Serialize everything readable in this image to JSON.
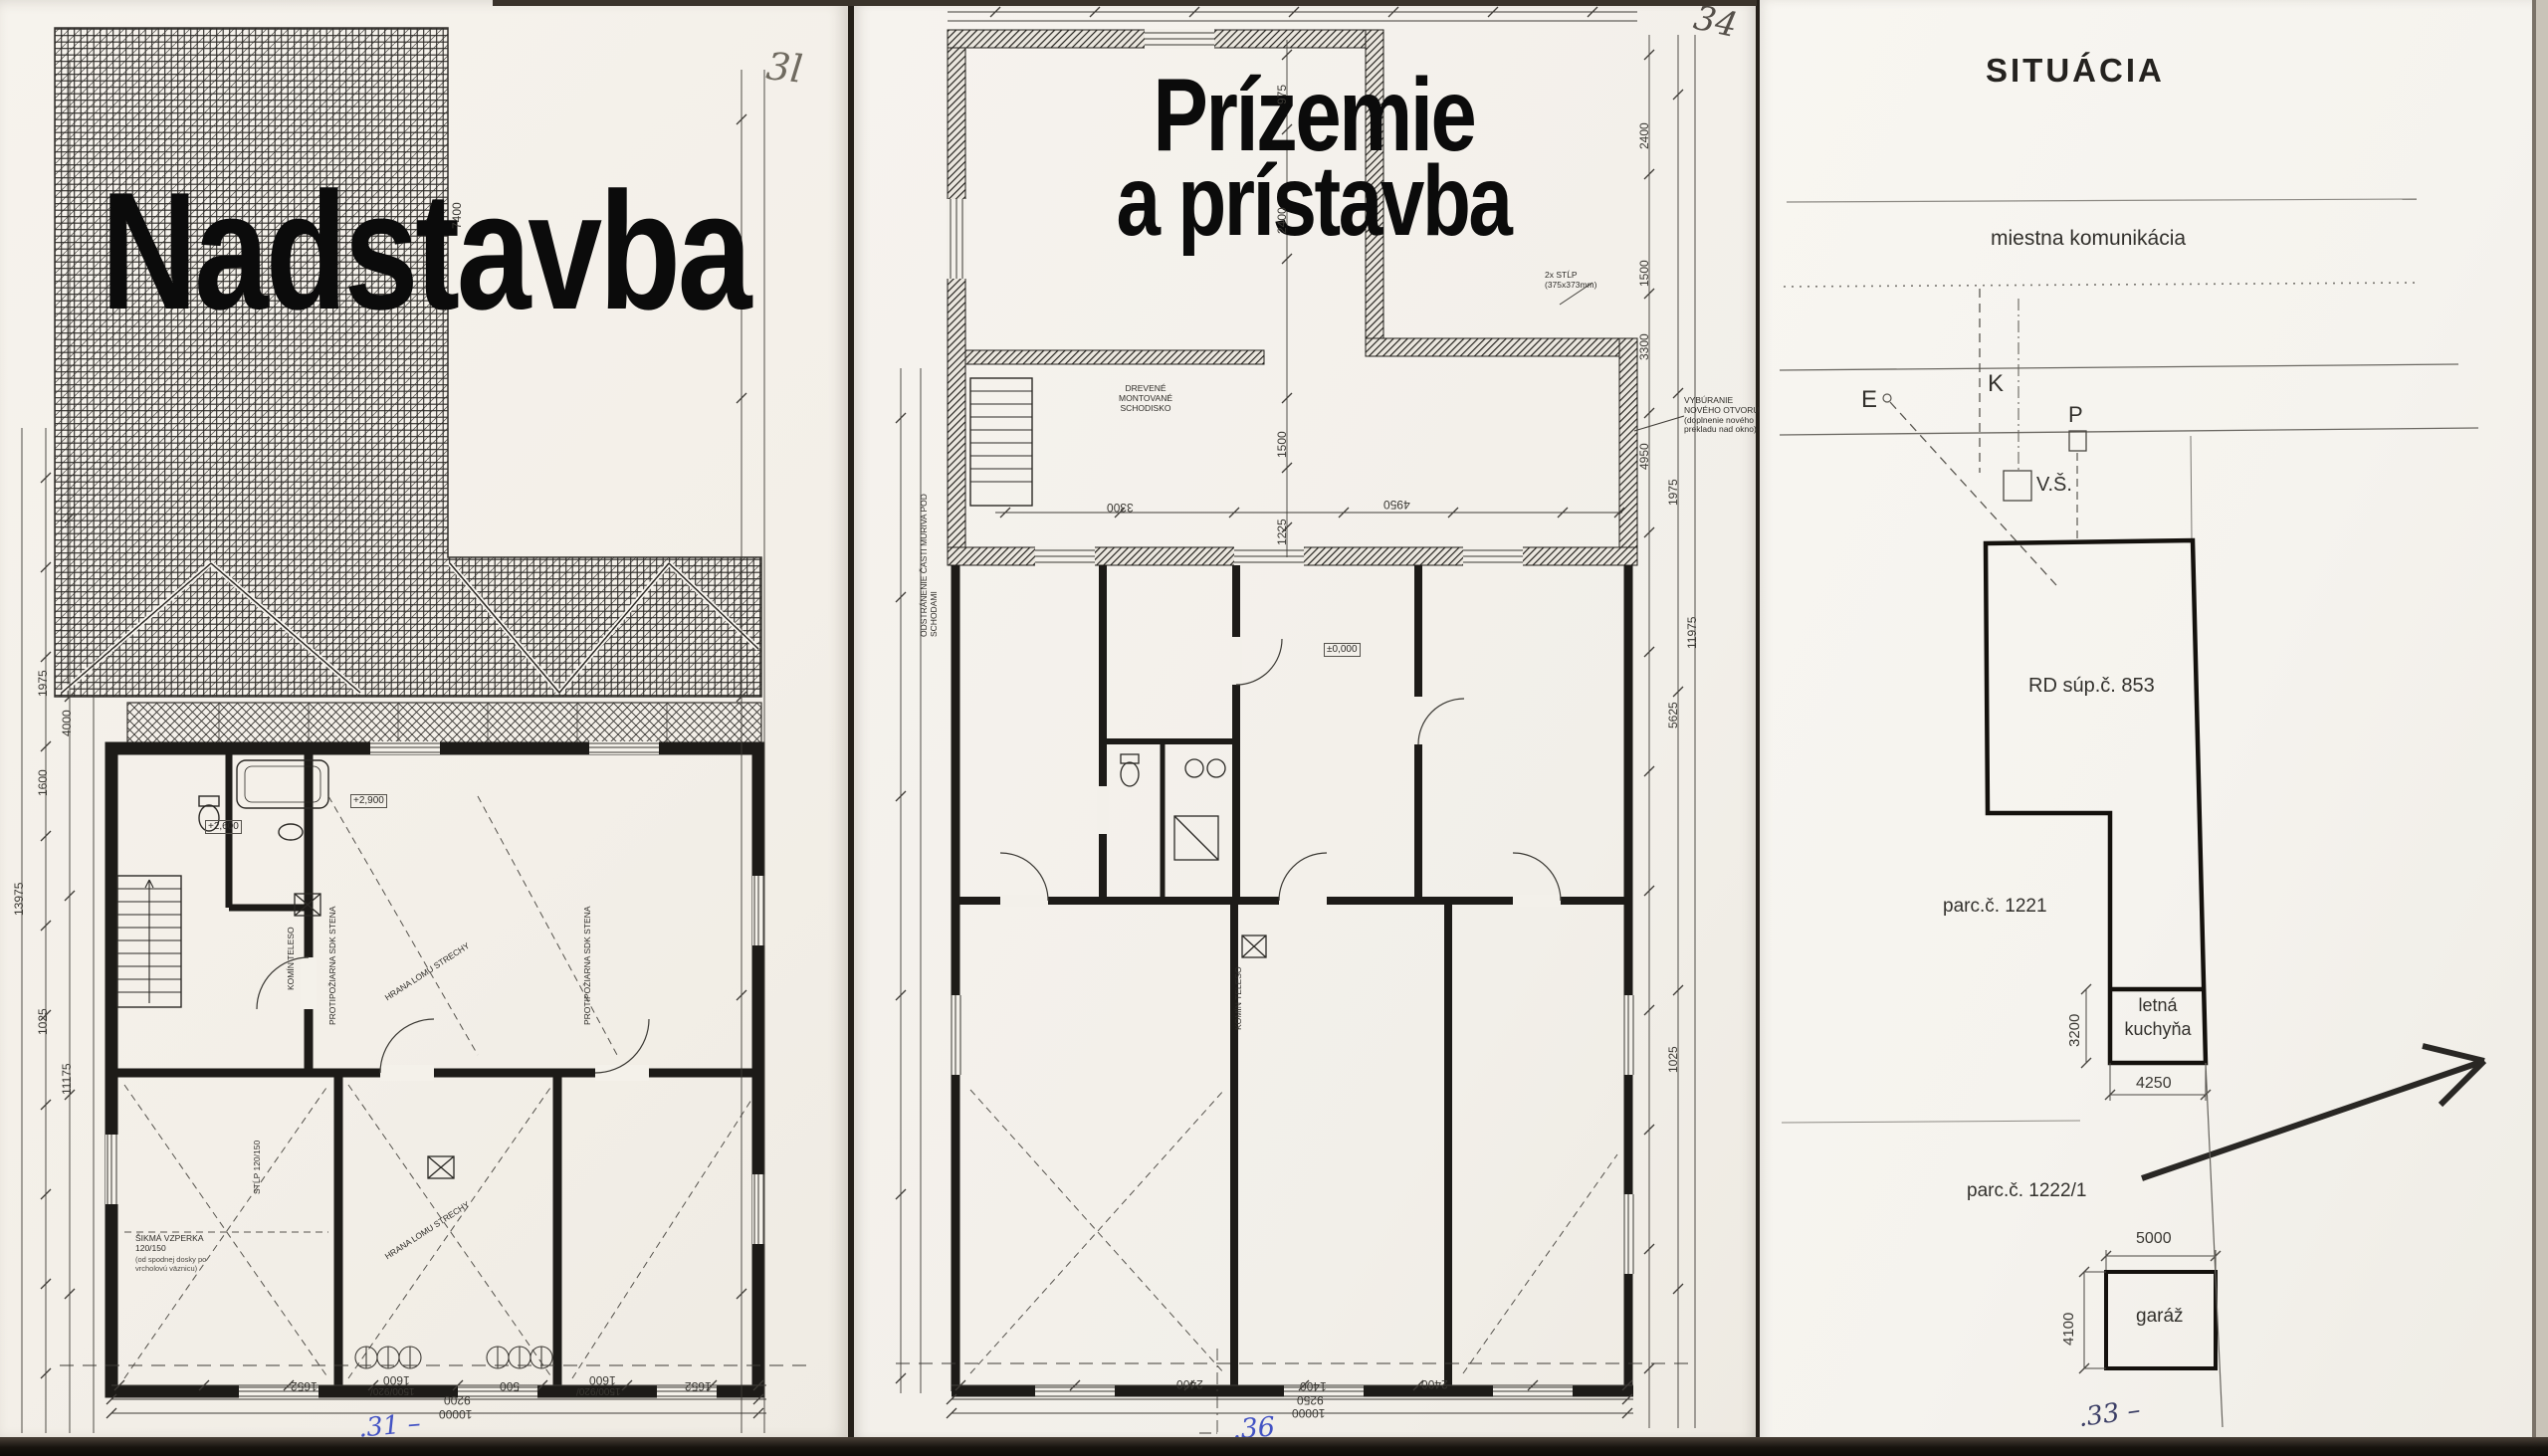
{
  "palette": {
    "paper": "#f5f2ec",
    "paper_right": "#f7f5f0",
    "ink": "#1c1a17",
    "pencil": "#6f6a60",
    "blue_ink": "#4353c4",
    "dark_blue_ink": "#3c3f66",
    "shadow": "#17130e"
  },
  "pages": {
    "left": {
      "corner_mark": "3l",
      "title": "Nadstavba",
      "annotations": {
        "fireproof_wall_1": "PROTIPOŽIARNA SDK STENA",
        "fireproof_wall_2": "PROTIPOŽIARNA SDK STENA",
        "roof_break_1": "HRANA LOMU STRECHY",
        "roof_break_2": "HRANA LOMU STRECHY",
        "brace": "ŠIKMÁ VZPERKA 120/150",
        "brace_note": "(od spodnej dosky po vrcholovú väznicu)",
        "column": "STĹP 120/150",
        "chimney": "KOMÍN TELESO",
        "level_1": "+2,900",
        "level_2": "+2,600"
      },
      "dims": {
        "left_chain": [
          "13975",
          "1975",
          "1600",
          "4000",
          "11175",
          "1025"
        ],
        "right_chain": [
          "7400"
        ],
        "bottom_row1": [
          "1652",
          "1600",
          "1500/920/",
          "500",
          "1600",
          "1500/920/",
          "1652"
        ],
        "bottom_row2": "9200",
        "bottom_row3": "10000"
      },
      "page_no": ".31 –"
    },
    "middle": {
      "corner_mark": "34",
      "title_line1": "Prízemie",
      "title_line2": "a prístavba",
      "annotations": {
        "stairs": "DREVENÉ MONTOVANÉ SCHODISKO",
        "demolition": "ODSTRÁNENIE ČASTI MURIVA POD SCHODAMI",
        "new_opening": "VYBÚRANIE NOVÉHO OTVORU (doplnenie nového prekladu nad okno)",
        "column": "2x STĹP (375x373mm)",
        "chimney": "KOMÍN TELESO",
        "level": "±0,000"
      },
      "dims": {
        "inner_chain": [
          "975",
          "2400",
          "1500",
          "1225"
        ],
        "right_chain": [
          "2400",
          "1500",
          "3300",
          "4950",
          "1975",
          "5625",
          "11975",
          "1025"
        ],
        "inner_h": [
          "3300",
          "4950"
        ],
        "bottom_row1": [
          "2400",
          "1400",
          "2400"
        ],
        "bottom_row2": "9250",
        "bottom_row3": "10000"
      },
      "page_no": ".36"
    },
    "right": {
      "title": "SITUÁCIA",
      "road_label": "miestna komunikácia",
      "markers": {
        "e": "E",
        "k": "K",
        "p": "P",
        "shaft": "V.Š."
      },
      "house_label": "RD súp.č. 853",
      "parcel_1221": "parc.č. 1221",
      "parcel_1222": "parc.č. 1222/1",
      "summer_kitchen_line1": "letná",
      "summer_kitchen_line2": "kuchyňa",
      "garage_label": "garáž",
      "dims": {
        "kitchen_h": "3200",
        "kitchen_w": "4250",
        "garage_w": "5000",
        "garage_h": "4100"
      },
      "page_no": ".33 –"
    }
  }
}
